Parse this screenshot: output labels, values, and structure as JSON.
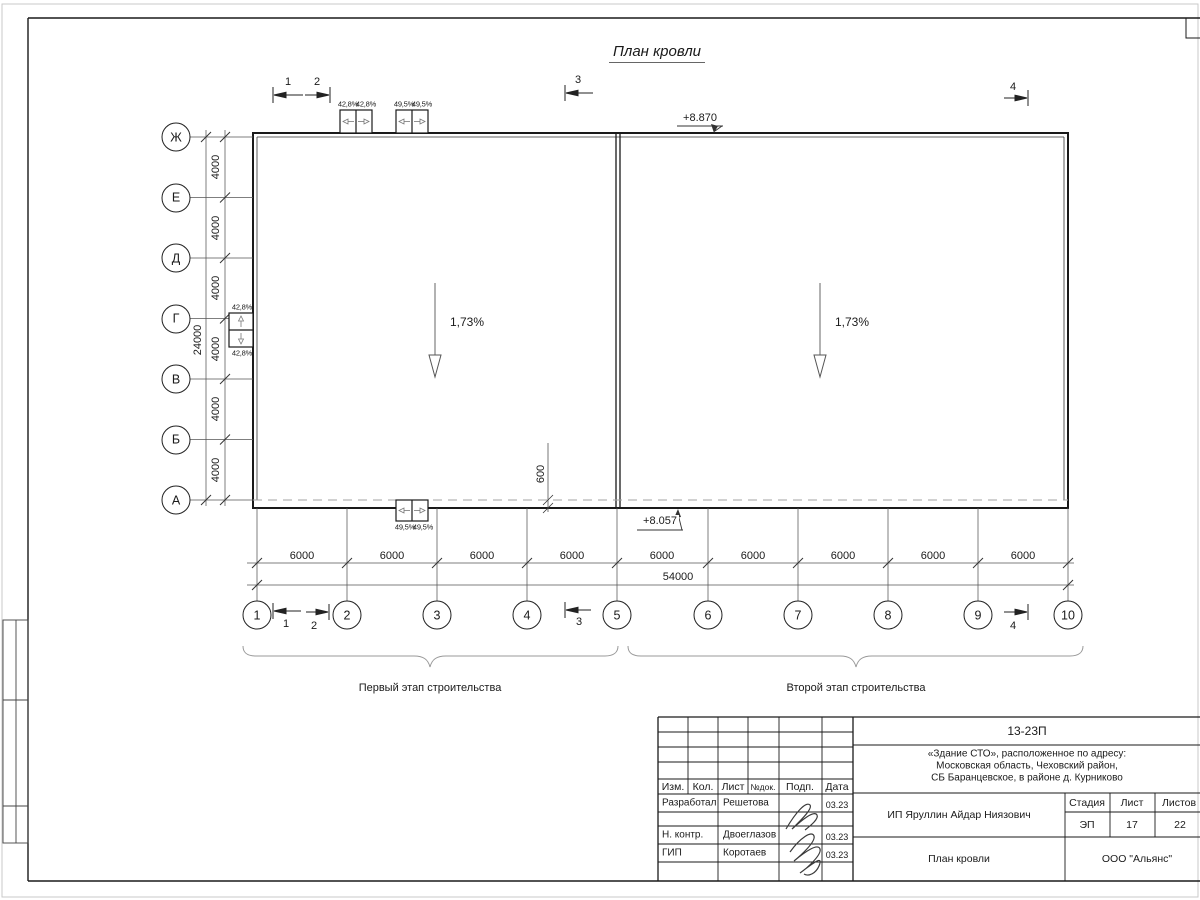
{
  "sheet_title": "План кровли",
  "plan": {
    "elevation_top": "+8.870",
    "elevation_bottom": "+8.057",
    "slope_left": "1,73%",
    "slope_right": "1,73%",
    "offset_dim": "600",
    "hatch": {
      "top_a1": "42,8%",
      "top_a2": "42,8%",
      "top_b1": "49,5%",
      "top_b2": "49,5%",
      "left_1": "42,8%",
      "left_2": "42,8%",
      "bottom_1": "49,5%",
      "bottom_2": "49,5%"
    },
    "stage_left": "Первый этап строительства",
    "stage_right": "Второй этап строительства"
  },
  "grid": {
    "rows": [
      "Ж",
      "Е",
      "Д",
      "Г",
      "В",
      "Б",
      "А"
    ],
    "cols": [
      "1",
      "2",
      "3",
      "4",
      "5",
      "6",
      "7",
      "8",
      "9",
      "10"
    ],
    "row_dims": [
      "4000",
      "4000",
      "4000",
      "4000",
      "4000",
      "4000"
    ],
    "row_total": "24000",
    "col_dims": [
      "6000",
      "6000",
      "6000",
      "6000",
      "6000",
      "6000",
      "6000",
      "6000",
      "6000"
    ],
    "col_total": "54000"
  },
  "sections": [
    "1",
    "2",
    "3",
    "4"
  ],
  "titleblock": {
    "doc_number": "13-23П",
    "address_line1": "«Здание СТО», расположенное по адресу:",
    "address_line2": "Московская область, Чеховский район,",
    "address_line3": "СБ Баранцевское, в районе д. Курниково",
    "rev_header": [
      "Изм.",
      "Кол.",
      "Лист",
      "№док.",
      "Подп.",
      "Дата"
    ],
    "sign_rows": [
      {
        "role": "Разработал",
        "name": "Решетова",
        "date": "03.23"
      },
      {
        "role": "Н. контр.",
        "name": "Двоеглазов",
        "date": "03.23"
      },
      {
        "role": "ГИП",
        "name": "Коротаев",
        "date": "03.23"
      }
    ],
    "client": "ИП Яруллин Айдар Ниязович",
    "stage_label": "Стадия",
    "stage_value": "ЭП",
    "sheet_label": "Лист",
    "sheet_value": "17",
    "sheets_label": "Листов",
    "sheets_value": "22",
    "drawing_title": "План кровли",
    "company": "ООО \"Альянс\""
  }
}
